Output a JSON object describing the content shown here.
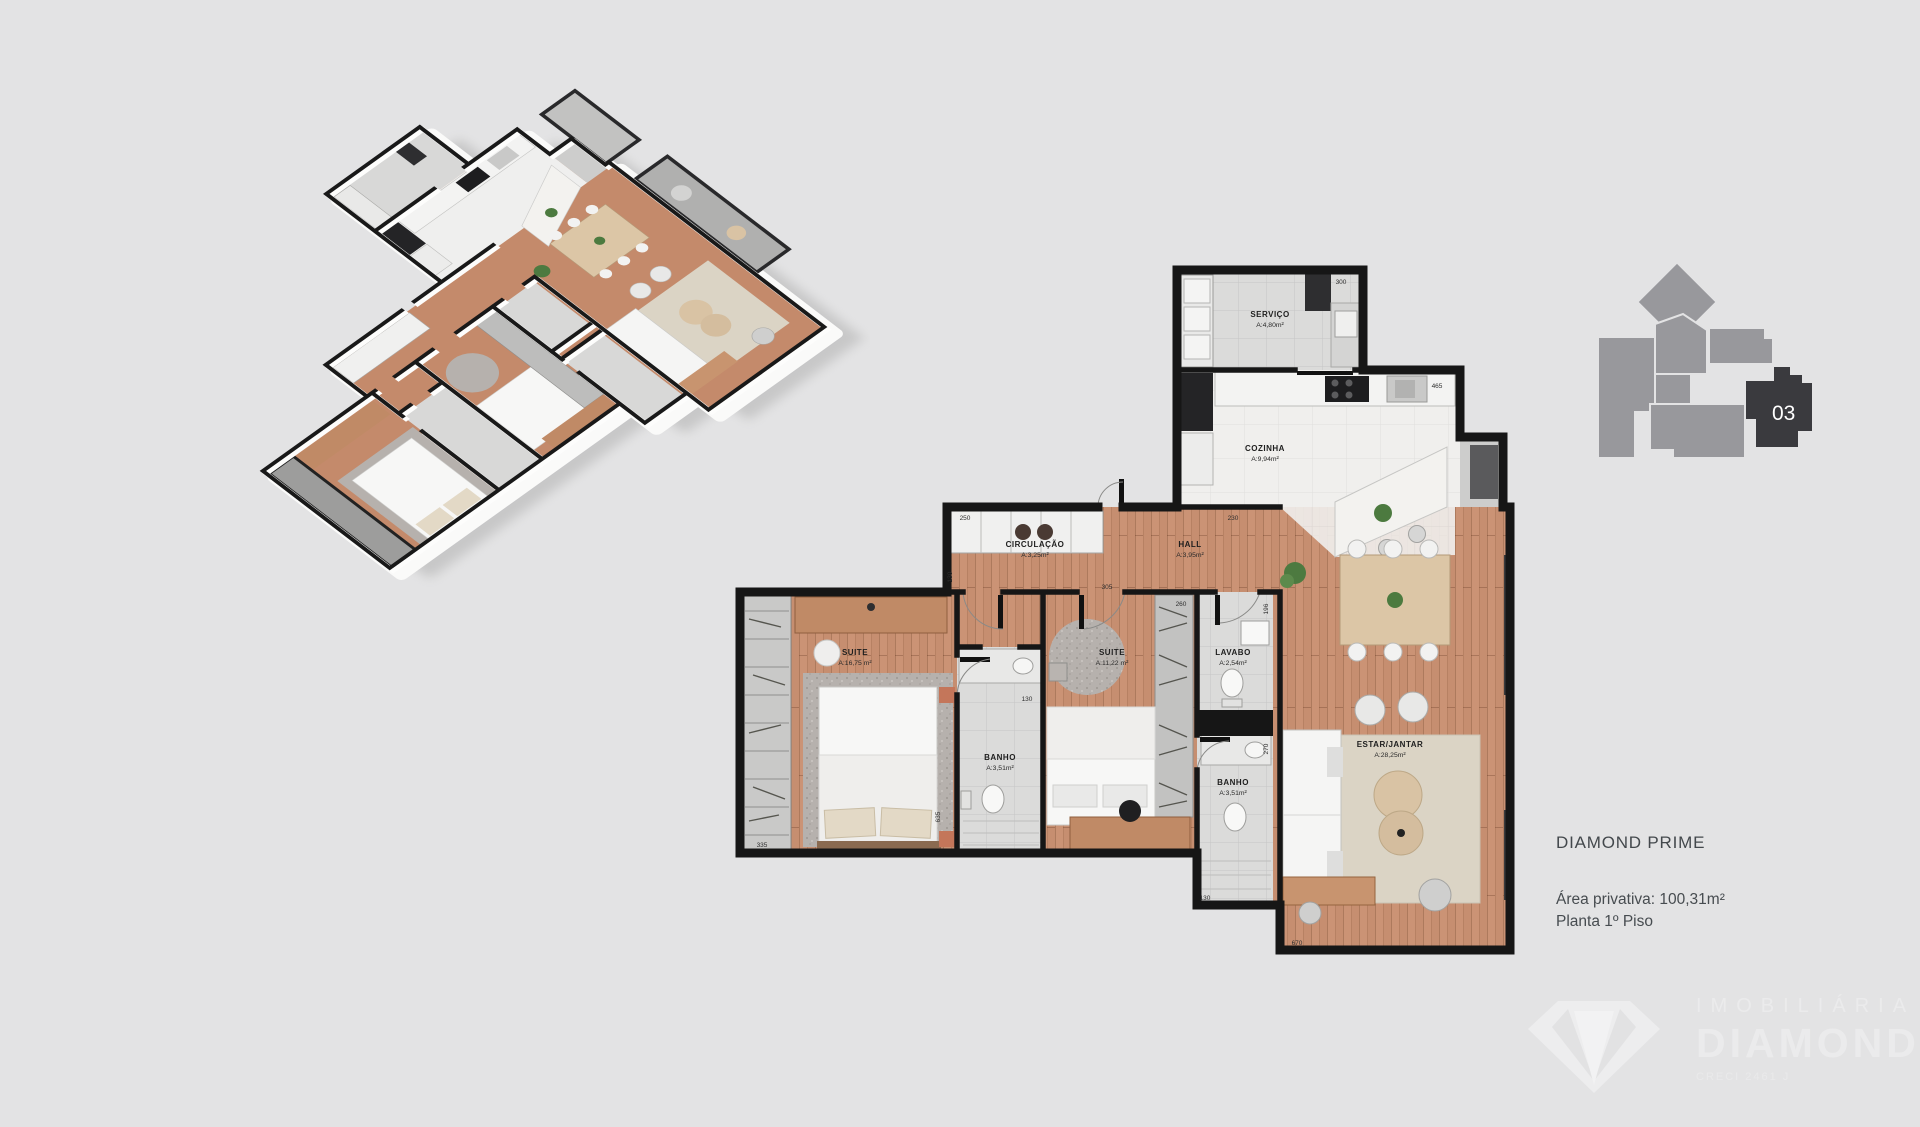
{
  "info": {
    "title": "DIAMOND PRIME",
    "area_line": "Área privativa: 100,31m²",
    "floor_line": "Planta 1º Piso"
  },
  "keyplan": {
    "unit": "03"
  },
  "watermark": {
    "line1": "IMOBILIÁRIA",
    "line2": "DIAMOND",
    "line3": "CRECI 2461 J"
  },
  "plan2d": {
    "rooms": [
      {
        "name": "SERVIÇO",
        "area": "A:4,80m²"
      },
      {
        "name": "COZINHA",
        "area": "A:9,94m²"
      },
      {
        "name": "CIRCULAÇÃO",
        "area": "A:3,25m²"
      },
      {
        "name": "HALL",
        "area": "A:3,95m²"
      },
      {
        "name": "SUITE",
        "area": "A:16,75 m²"
      },
      {
        "name": "BANHO",
        "area": "A:3,51m²"
      },
      {
        "name": "SUITE",
        "area": "A:11,22 m²"
      },
      {
        "name": "LAVABO",
        "area": "A:2,54m²"
      },
      {
        "name": "BANHO",
        "area": "A:3,51m²"
      },
      {
        "name": "ESTAR/JANTAR",
        "area": "A:28,25m²"
      }
    ],
    "dims": [
      "300",
      "465",
      "250",
      "230",
      "130",
      "305",
      "260",
      "196",
      "130",
      "335",
      "635",
      "270",
      "130",
      "670"
    ]
  },
  "colors": {
    "background": "#e3e3e4",
    "wall": "#161616",
    "wood": "#c68e70",
    "tile": "#dbdbda",
    "kitchen_floor": "#f0efed",
    "rug_living": "#dbd4c5",
    "rug_suite": "#b6b1ad",
    "furniture_wood": "#c89067",
    "keyplan_gray": "#98989c",
    "keyplan_unit": "#3a3a3e"
  }
}
